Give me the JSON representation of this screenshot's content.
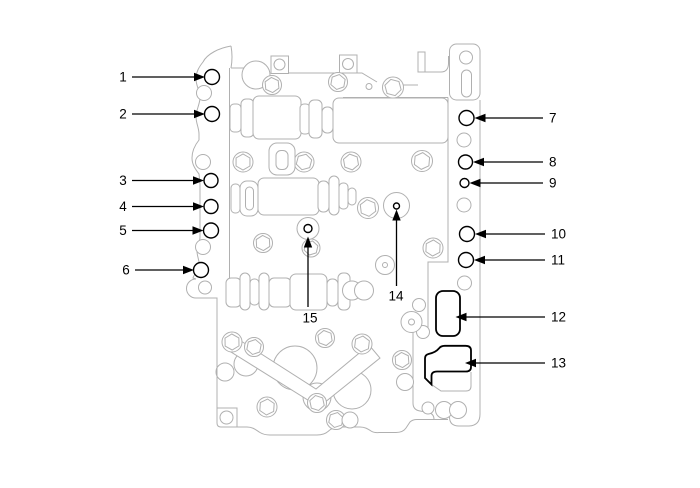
{
  "figure": {
    "type": "parts-callout-line-drawing",
    "subject": "transaxle-valve-body",
    "background_color": "#ffffff",
    "line_color": "#b0b0b0",
    "callout_color": "#000000",
    "callout_count": 15
  },
  "callouts": [
    {
      "label": "1"
    },
    {
      "label": "2"
    },
    {
      "label": "3"
    },
    {
      "label": "4"
    },
    {
      "label": "5"
    },
    {
      "label": "6"
    },
    {
      "label": "7"
    },
    {
      "label": "8"
    },
    {
      "label": "9"
    },
    {
      "label": "10"
    },
    {
      "label": "11"
    },
    {
      "label": "12"
    },
    {
      "label": "13"
    },
    {
      "label": "14"
    },
    {
      "label": "15"
    }
  ]
}
